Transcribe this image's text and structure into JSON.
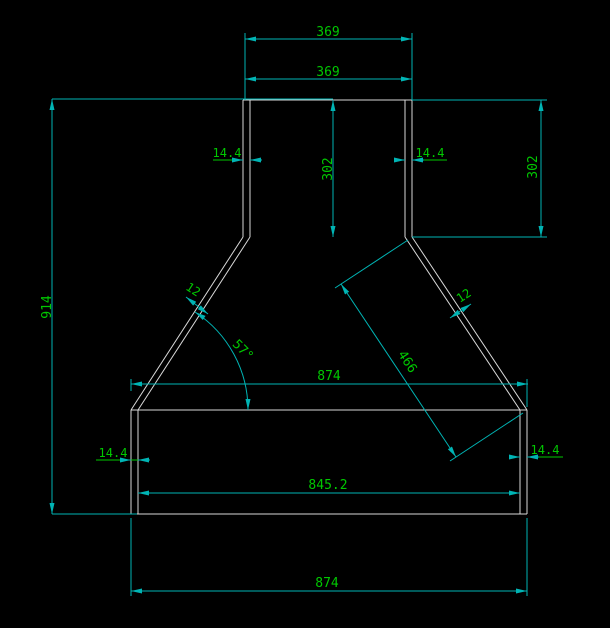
{
  "canvas": {
    "background": "#000000"
  },
  "colors": {
    "geometry": "#d9d9d9",
    "dimension_lines": "#00b4b4",
    "dimension_text": "#00c800"
  },
  "drawing": {
    "kind": "cad-technical-drawing",
    "dimensions": {
      "neck_width_upper": "369",
      "neck_width_lower": "369",
      "overall_height": "914",
      "neck_height_center": "302",
      "neck_height_right": "302",
      "neck_wall_left": "14.4",
      "neck_wall_right": "14.4",
      "slope_wall_left": "12",
      "slope_wall_right": "12",
      "slope_angle": "57°",
      "slope_length": "466",
      "body_width_top": "874",
      "body_width_inner": "845.2",
      "body_wall_left": "14.4",
      "body_wall_right": "14.4",
      "body_width_bottom": "874"
    }
  }
}
